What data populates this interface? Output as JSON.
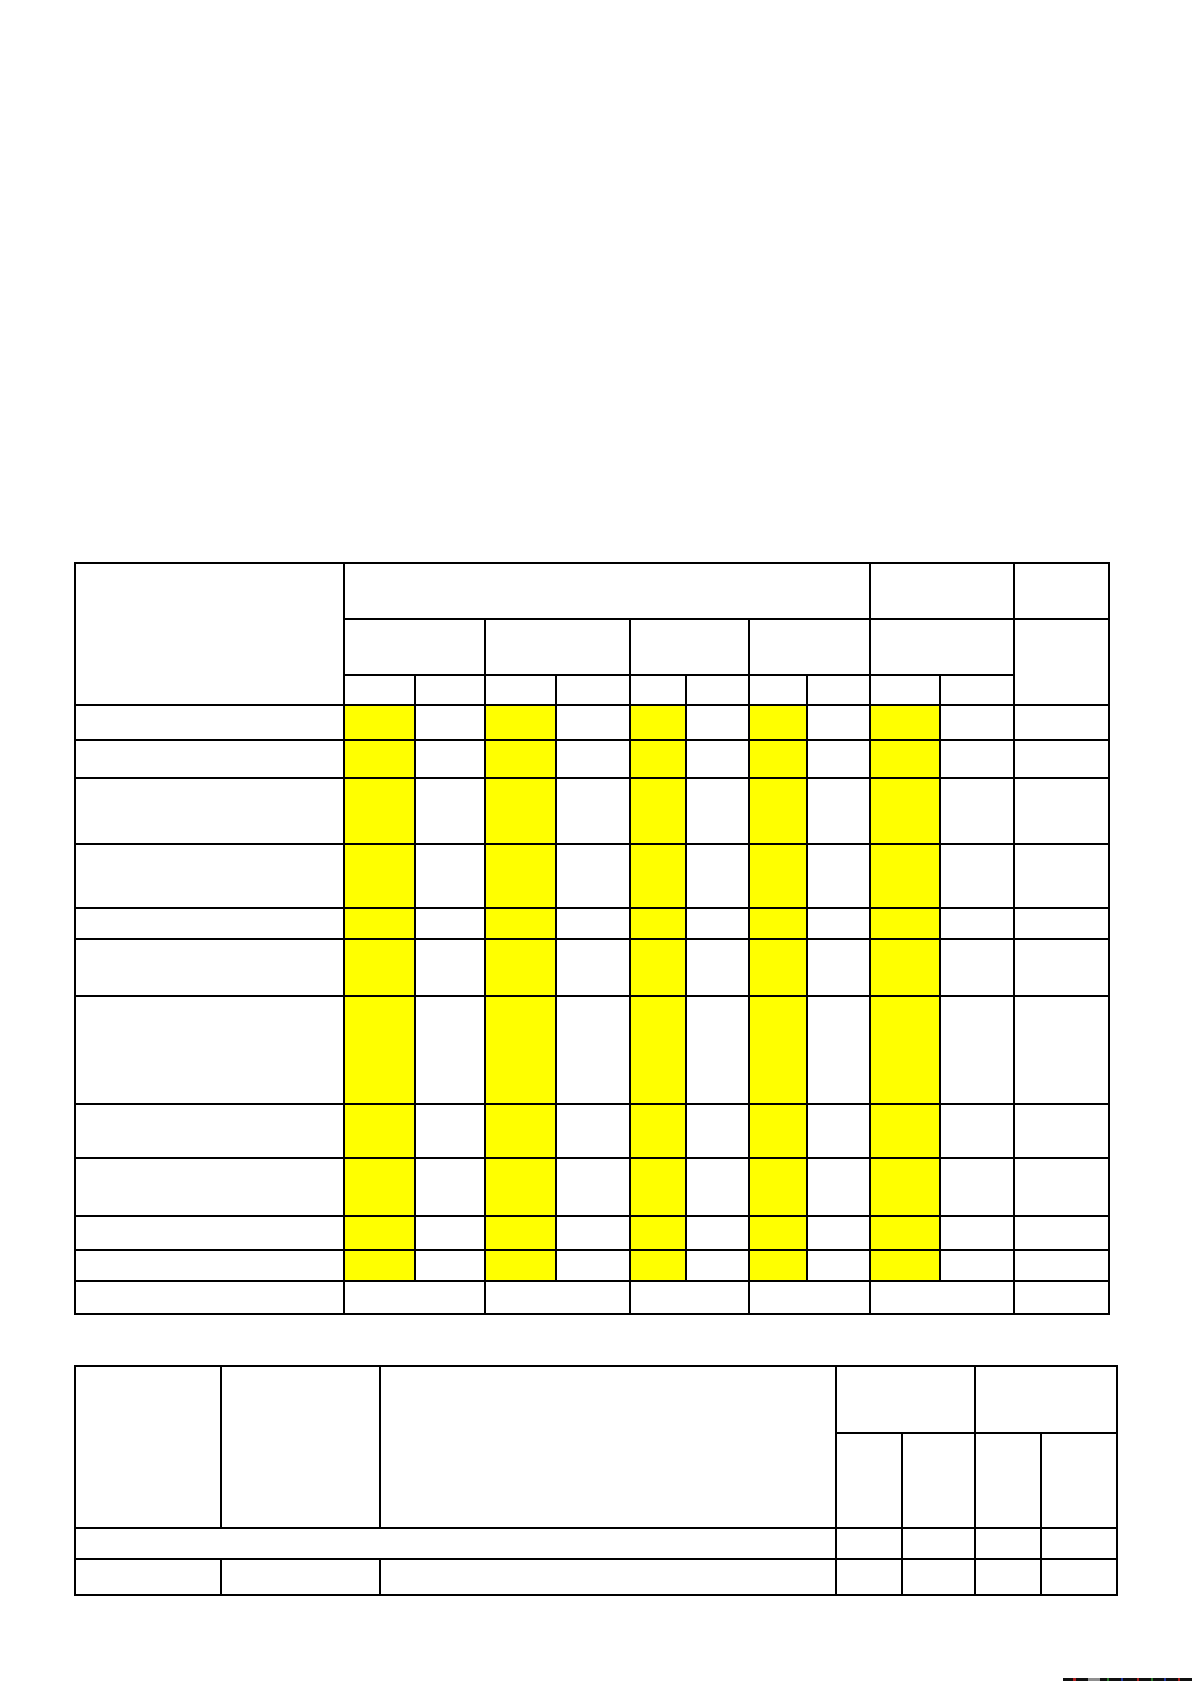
{
  "page": {
    "width_px": 1192,
    "height_px": 1685,
    "background": "#ffffff"
  },
  "colors": {
    "highlight_yellow": "#ffff00",
    "table_border": "#000000",
    "edge_strip_dark": "#101010",
    "edge_strip_gray": "#8f8f8f"
  },
  "main_table": {
    "name": "main-grid-table",
    "left": 74,
    "top": 562,
    "width": 1034,
    "col_widths": [
      269,
      71,
      70,
      71,
      74,
      56,
      63,
      58,
      63,
      70,
      74,
      95
    ],
    "rows": [
      {
        "h": 56,
        "kind": "header",
        "cells": [
          {
            "rs": 3
          },
          {
            "cs": 8
          },
          {
            "cs": 2
          },
          {}
        ]
      },
      {
        "h": 56,
        "kind": "header",
        "cells": [
          {
            "cs": 2
          },
          {
            "cs": 2
          },
          {
            "cs": 2
          },
          {
            "cs": 2
          },
          {
            "cs": 2
          },
          {
            "rs": 2
          }
        ]
      },
      {
        "h": 30,
        "kind": "header",
        "cells": [
          {},
          {},
          {},
          {},
          {},
          {},
          {},
          {},
          {},
          {}
        ]
      },
      {
        "h": 35,
        "kind": "data",
        "cells": [
          {},
          {
            "hl": true
          },
          {},
          {
            "hl": true
          },
          {},
          {
            "hl": true
          },
          {},
          {
            "hl": true
          },
          {},
          {
            "hl": true
          },
          {},
          {}
        ]
      },
      {
        "h": 38,
        "kind": "data",
        "cells": [
          {},
          {
            "hl": true
          },
          {},
          {
            "hl": true
          },
          {},
          {
            "hl": true
          },
          {},
          {
            "hl": true
          },
          {},
          {
            "hl": true
          },
          {},
          {}
        ]
      },
      {
        "h": 66,
        "kind": "data",
        "cells": [
          {},
          {
            "hl": true
          },
          {},
          {
            "hl": true
          },
          {},
          {
            "hl": true
          },
          {},
          {
            "hl": true
          },
          {},
          {
            "hl": true
          },
          {},
          {}
        ]
      },
      {
        "h": 64,
        "kind": "data",
        "cells": [
          {},
          {
            "hl": true
          },
          {},
          {
            "hl": true
          },
          {},
          {
            "hl": true
          },
          {},
          {
            "hl": true
          },
          {},
          {
            "hl": true
          },
          {},
          {}
        ]
      },
      {
        "h": 31,
        "kind": "data",
        "cells": [
          {},
          {
            "hl": true
          },
          {},
          {
            "hl": true
          },
          {},
          {
            "hl": true
          },
          {},
          {
            "hl": true
          },
          {},
          {
            "hl": true
          },
          {},
          {}
        ]
      },
      {
        "h": 57,
        "kind": "data",
        "cells": [
          {},
          {
            "hl": true
          },
          {},
          {
            "hl": true
          },
          {},
          {
            "hl": true
          },
          {},
          {
            "hl": true
          },
          {},
          {
            "hl": true
          },
          {},
          {}
        ]
      },
      {
        "h": 108,
        "kind": "data",
        "cells": [
          {},
          {
            "hl": true
          },
          {},
          {
            "hl": true
          },
          {},
          {
            "hl": true
          },
          {},
          {
            "hl": true
          },
          {},
          {
            "hl": true
          },
          {},
          {}
        ]
      },
      {
        "h": 54,
        "kind": "data",
        "cells": [
          {},
          {
            "hl": true
          },
          {},
          {
            "hl": true
          },
          {},
          {
            "hl": true
          },
          {},
          {
            "hl": true
          },
          {},
          {
            "hl": true
          },
          {},
          {}
        ]
      },
      {
        "h": 58,
        "kind": "data",
        "cells": [
          {},
          {
            "hl": true
          },
          {},
          {
            "hl": true
          },
          {},
          {
            "hl": true
          },
          {},
          {
            "hl": true
          },
          {},
          {
            "hl": true
          },
          {},
          {}
        ]
      },
      {
        "h": 34,
        "kind": "data",
        "cells": [
          {},
          {
            "hl": true
          },
          {},
          {
            "hl": true
          },
          {},
          {
            "hl": true
          },
          {},
          {
            "hl": true
          },
          {},
          {
            "hl": true
          },
          {},
          {}
        ]
      },
      {
        "h": 31,
        "kind": "data",
        "cells": [
          {},
          {
            "hl": true
          },
          {},
          {
            "hl": true
          },
          {},
          {
            "hl": true
          },
          {},
          {
            "hl": true
          },
          {},
          {
            "hl": true
          },
          {},
          {}
        ]
      },
      {
        "h": 33,
        "kind": "data",
        "cells": [
          {},
          {
            "cs": 2
          },
          {
            "cs": 2
          },
          {
            "cs": 2
          },
          {
            "cs": 2
          },
          {
            "cs": 2
          },
          {}
        ]
      }
    ]
  },
  "title_block": {
    "name": "title-block-table",
    "left": 74,
    "top": 1365,
    "width": 1042,
    "col_widths": [
      146,
      159,
      456,
      66,
      73,
      66,
      76
    ],
    "rows": [
      {
        "h": 67,
        "kind": "data",
        "cells": [
          {
            "rs": 2
          },
          {
            "rs": 2
          },
          {
            "rs": 2
          },
          {
            "cs": 2
          },
          {
            "cs": 2
          }
        ]
      },
      {
        "h": 95,
        "kind": "data",
        "cells": [
          {},
          {},
          {},
          {}
        ]
      },
      {
        "h": 31,
        "kind": "data",
        "cells": [
          {
            "cs": 3
          },
          {},
          {},
          {},
          {}
        ]
      },
      {
        "h": 36,
        "kind": "data",
        "cells": [
          {},
          {},
          {},
          {},
          {},
          {},
          {}
        ]
      }
    ]
  },
  "bottom_edge_artifact": {
    "left": 1063,
    "top": 1678,
    "width": 129,
    "height": 3,
    "base_color": "#101010",
    "segments": [
      {
        "x": 10,
        "w": 3,
        "color": "#b02020"
      },
      {
        "x": 25,
        "w": 12,
        "color": "#8f8f8f"
      },
      {
        "x": 44,
        "w": 2,
        "color": "#2a7a2a"
      },
      {
        "x": 58,
        "w": 2,
        "color": "#2038a0"
      },
      {
        "x": 74,
        "w": 2,
        "color": "#b02020"
      },
      {
        "x": 88,
        "w": 2,
        "color": "#2a7a2a"
      },
      {
        "x": 101,
        "w": 2,
        "color": "#2038a0"
      },
      {
        "x": 115,
        "w": 2,
        "color": "#b02020"
      }
    ]
  }
}
